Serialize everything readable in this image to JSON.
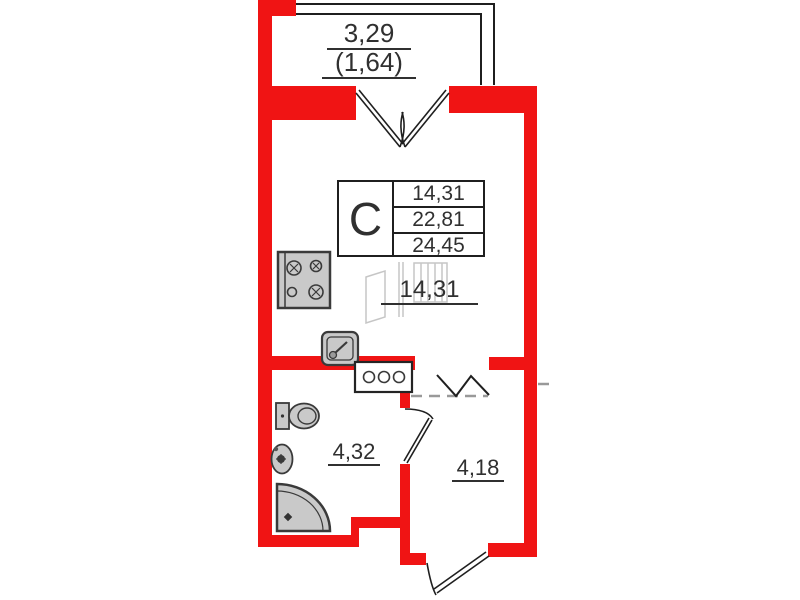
{
  "balcony": {
    "area": "3,29",
    "reduced_area": "(1,64)"
  },
  "unit": {
    "type": "С",
    "rows": [
      "14,31",
      "22,81",
      "24,45"
    ]
  },
  "rooms": {
    "living": "14,31",
    "bathroom": "4,32",
    "hallway": "4,18"
  },
  "fixtures": [
    "stove",
    "kitchen-sink",
    "washing-machine",
    "toilet",
    "washbasin",
    "corner-shower"
  ],
  "openings": [
    "balcony-french-door",
    "open-passage",
    "bathroom-door",
    "entrance-door"
  ],
  "colors": {
    "wall_red": "#f01414",
    "fixture_gray": "#c9c9c9",
    "line_black": "#1f1f1f",
    "dashed_gray": "#999999",
    "sketch_gray": "#c6c6c6",
    "text_color": "#303030"
  }
}
